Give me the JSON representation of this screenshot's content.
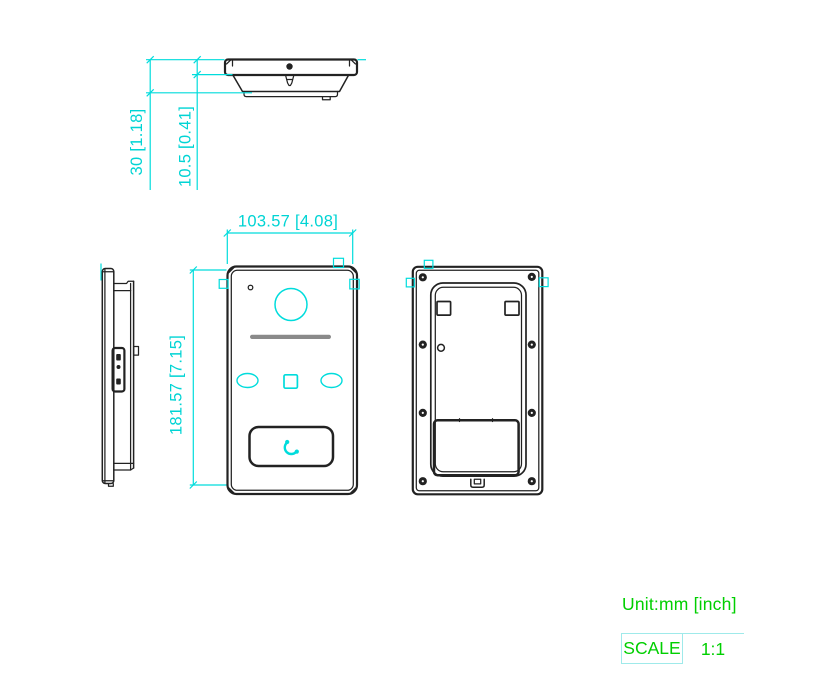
{
  "drawing": {
    "dimensions": {
      "total_depth": "30 [1.18]",
      "flange_depth": "10.5 [0.41]",
      "width": "103.57 [4.08]",
      "height": "181.57 [7.15]"
    },
    "unit_label": "Unit:mm [inch]",
    "scale_table": {
      "label": "SCALE",
      "value": "1:1"
    },
    "icons": {
      "call_button_icon": "phone-handset-icon"
    },
    "colors": {
      "dimension_cyan": "#00dcdc",
      "annotation_green": "#00cf00",
      "outline_black": "#222222",
      "speaker_gray": "#8a8a8a",
      "table_border_cyan": "#9feaea"
    }
  }
}
